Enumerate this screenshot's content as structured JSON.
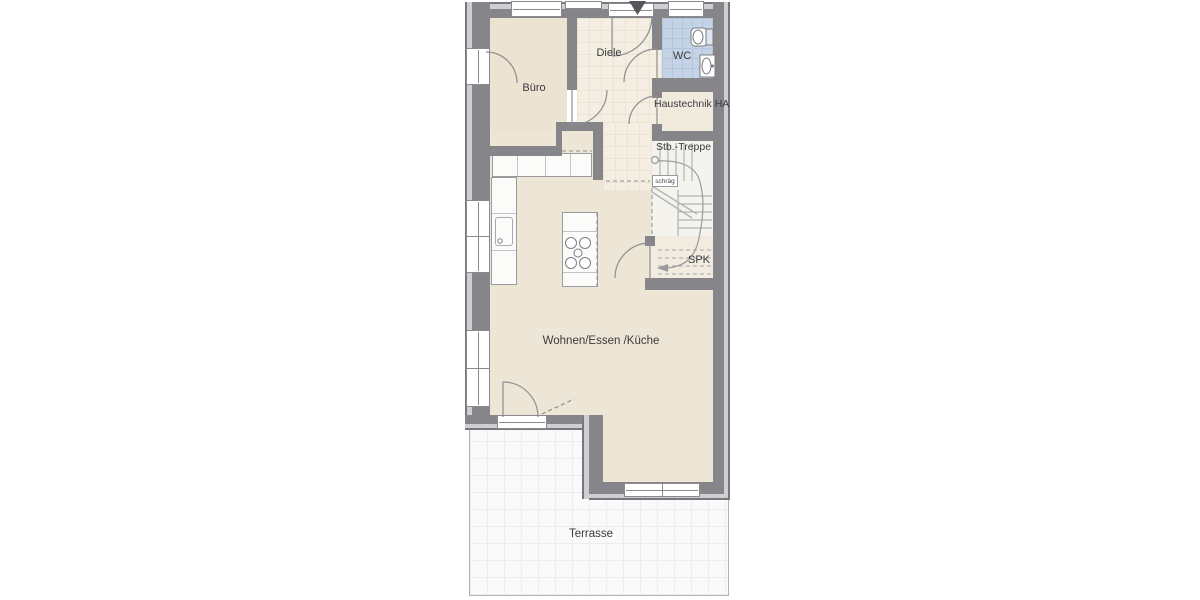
{
  "plan": {
    "type": "floor-plan",
    "rooms": {
      "buero": {
        "label": "Büro"
      },
      "diele": {
        "label": "Diele"
      },
      "wc": {
        "label": "WC"
      },
      "haustechnik": {
        "label": "Haustechnik HA"
      },
      "treppe": {
        "label": "Stb.-Treppe"
      },
      "schraeg": {
        "label": "schräg"
      },
      "spk": {
        "label": "SPK"
      },
      "wohnen": {
        "label": "Wohnen/Essen /Küche"
      },
      "terrasse": {
        "label": "Terrasse"
      }
    },
    "colors": {
      "wall": "#85858a",
      "wall_lining": "#cfcfd3",
      "floor_beige": "#ede5d5",
      "floor_tile": "#f4efe2",
      "wc_blue": "#c4d3e6",
      "terrace": "#fafafa"
    }
  }
}
